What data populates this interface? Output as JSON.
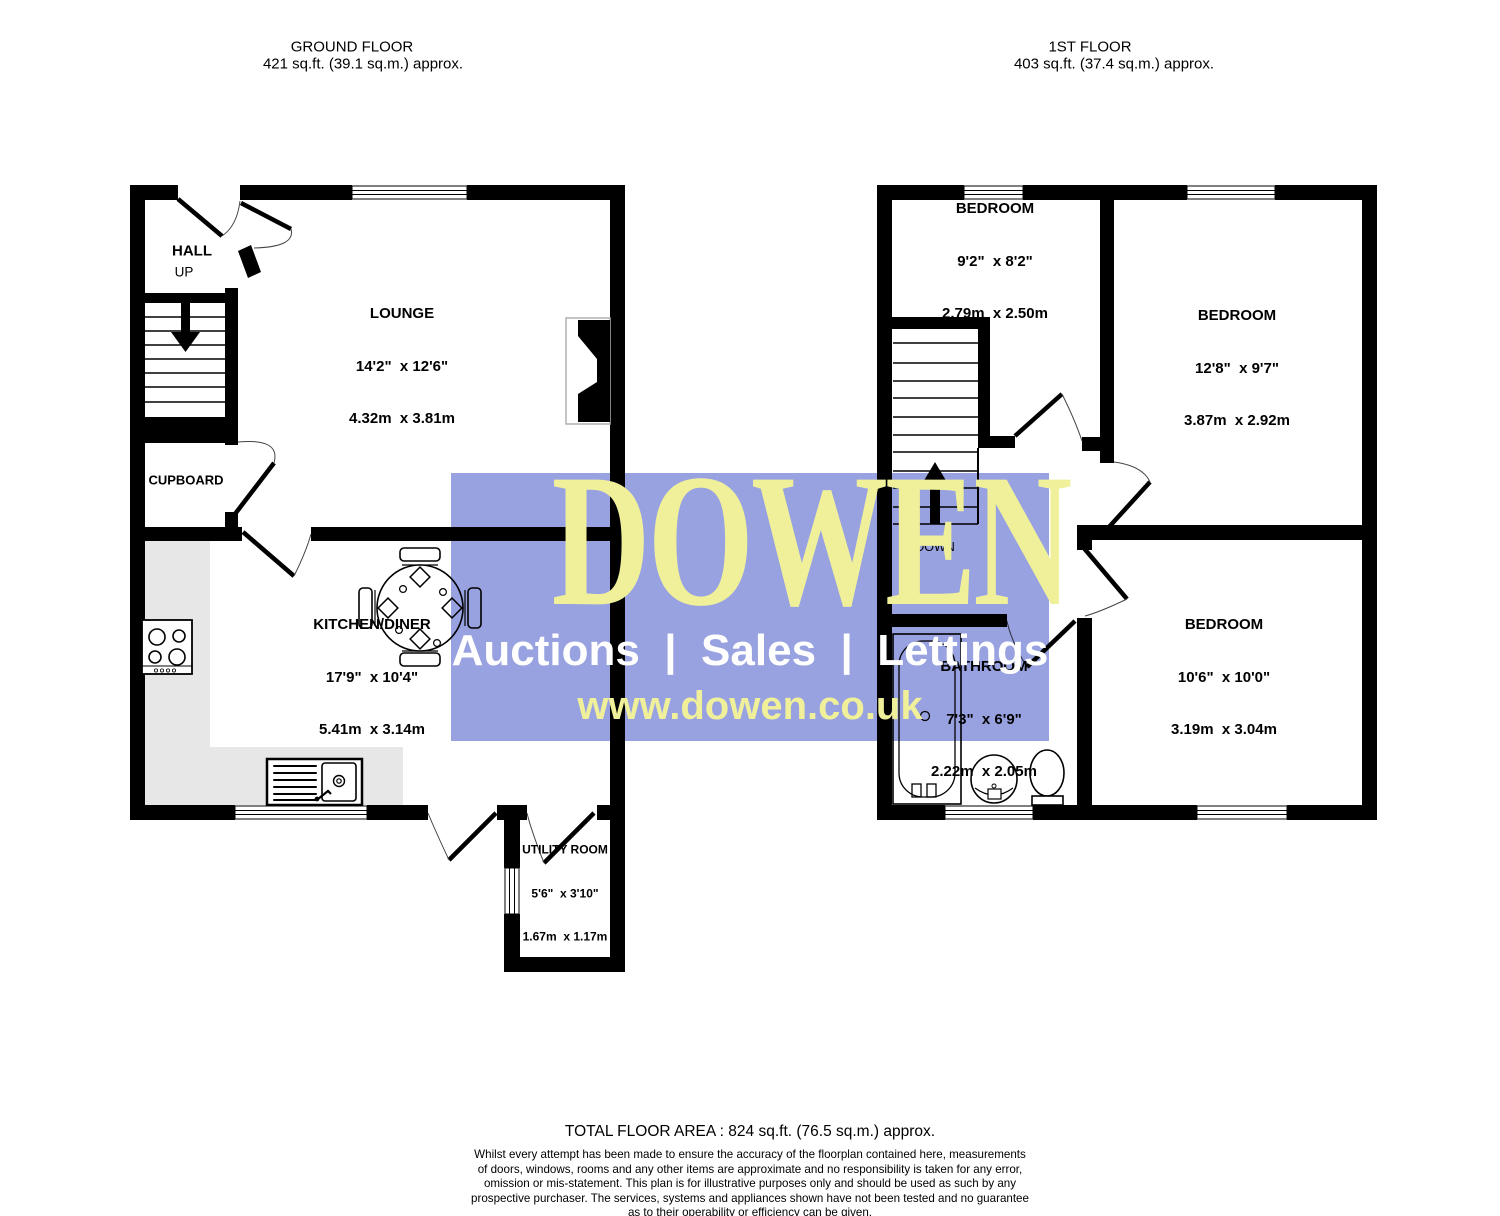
{
  "floors": [
    {
      "title": "GROUND FLOOR",
      "area": "421 sq.ft. (39.1 sq.m.) approx."
    },
    {
      "title": "1ST FLOOR",
      "area": "403 sq.ft. (37.4 sq.m.) approx."
    }
  ],
  "rooms": {
    "hall": {
      "name": "HALL"
    },
    "lounge": {
      "name": "LOUNGE",
      "dims_ft": "14'2\"  x 12'6\"",
      "dims_m": "4.32m  x 3.81m"
    },
    "cupboard": {
      "name": "CUPBOARD"
    },
    "kitchen": {
      "name": "KITCHEN/DINER",
      "dims_ft": "17'9\"  x 10'4\"",
      "dims_m": "5.41m  x 3.14m"
    },
    "utility": {
      "name": "UTILITY ROOM",
      "dims_ft": "5'6\"  x 3'10\"",
      "dims_m": "1.67m  x 1.17m"
    },
    "bedroom1": {
      "name": "BEDROOM",
      "dims_ft": "9'2\"  x 8'2\"",
      "dims_m": "2.79m  x 2.50m"
    },
    "bedroom2": {
      "name": "BEDROOM",
      "dims_ft": "12'8\"  x 9'7\"",
      "dims_m": "3.87m  x 2.92m"
    },
    "bedroom3": {
      "name": "BEDROOM",
      "dims_ft": "10'6\"  x 10'0\"",
      "dims_m": "3.19m  x 3.04m"
    },
    "bathroom": {
      "name": "BATHROOM",
      "dims_ft": "7'3\"  x 6'9\"",
      "dims_m": "2.22m  x 2.05m"
    }
  },
  "stairs": {
    "up_label": "UP",
    "down_label": "DOWN"
  },
  "watermark": {
    "brand": "DOWEN",
    "tagline": "Auctions  |  Sales  |  Lettings",
    "website": "www.dowen.co.uk",
    "box_color": "#98a2e0",
    "brand_color": "#f0f09b",
    "tagline_color": "#ffffff"
  },
  "footer": {
    "total": "TOTAL FLOOR AREA : 824 sq.ft. (76.5 sq.m.) approx.",
    "lines": [
      "Whilst every attempt has been made to ensure the accuracy of the floorplan contained here, measurements",
      "of doors, windows, rooms and any other items are approximate and no responsibility is taken for any error,",
      "omission or mis-statement. This plan is for illustrative purposes only and should be used as such by any",
      "prospective purchaser. The services, systems and appliances shown have not been tested and no guarantee",
      "as to their operability or efficiency can be given.",
      "Made with Metropix ©2025"
    ]
  }
}
